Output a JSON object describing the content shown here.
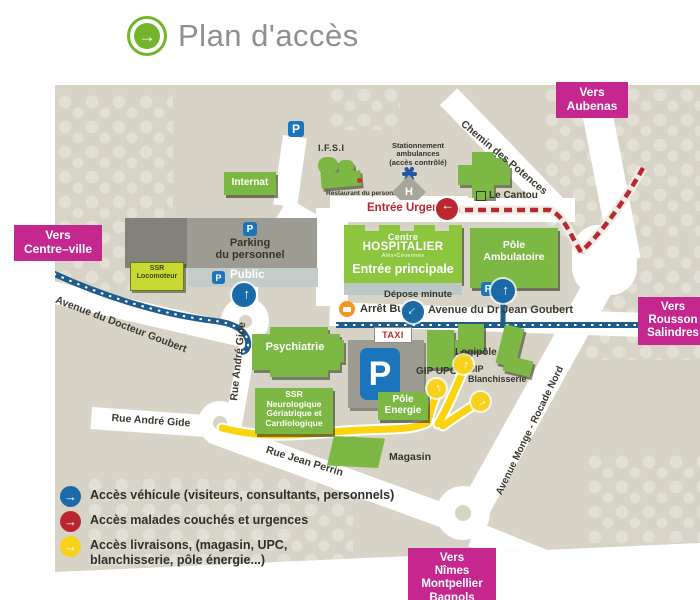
{
  "header": {
    "title": "Plan d'accès"
  },
  "directions": {
    "aubenas": "Vers\nAubenas",
    "centre_ville": "Vers\nCentre–ville",
    "rousson": "Vers\nRousson\nSalindres",
    "nimes": "Vers\nNîmes\nMontpellier\nBagnols"
  },
  "streets": {
    "chemin_des_potences": "Chemin des Potences",
    "avenue_docteur_goubert": "Avenue du Docteur Goubert",
    "rue_andre_gide_vertical": "Rue André Gide",
    "rue_andre_gide_horizontal": "Rue André Gide",
    "rue_jean_perrin": "Rue Jean Perrin",
    "avenue_dr_jean_goubert": "Avenue du Dr Jean Goubert",
    "avenue_monge": "Avenue Monge - Rocade Nord"
  },
  "hospital": {
    "logo_line1": "Centre",
    "logo_line2": "HOSPITALIER",
    "logo_line3": "Alès•Cévennes",
    "entree_principale": "Entrée principale",
    "entree_urgences": "Entrée  Urgences"
  },
  "buildings": {
    "internat": "Internat",
    "ifsi": "I.F.S.I",
    "restaurant_personnel": "Restaurant du personnel",
    "le_cantou": "Le Cantou",
    "parking_personnel": "Parking\ndu personnel",
    "parking_public": "Public",
    "ssr_locomoteur": "SSR\nLocomoteur",
    "pole_ambulatoire": "Pôle\nAmbulatoire",
    "psychiatrie": "Psychiatrie",
    "ssr_neurologique": "SSR\nNeurologique\nGériatrique et\nCardiologique",
    "pole_energie": "Pôle\nEnergie",
    "magasin": "Magasin",
    "logipole": "Logipôle",
    "gip_upc": "GIP UPC",
    "gip_blanchisserie": "GIP\nBlanchisserie"
  },
  "poi": {
    "taxi": "TAXI",
    "arret_bus": "Arrêt Bus",
    "depose_minute": "Dépose minute",
    "stationnement_ambulances": "Stationnement\nambulances\n(accès contrôlé)",
    "parking_letter": "P",
    "hopital_letter": "H"
  },
  "legend": {
    "items": [
      {
        "label": "Accès véhicule (visiteurs, consultants, personnels)",
        "color": "#1a6aa8"
      },
      {
        "label": "Accès malades couchés et urgences",
        "color": "#bb2730"
      },
      {
        "label": "Accès livraisons, (magasin, UPC,\nblanchisserie, pôle énergie...)",
        "color": "#f8d21a"
      }
    ]
  },
  "colors": {
    "map_background": "#d7d4c7",
    "building_green": "#7cb843",
    "hospital_green": "#8cc63e",
    "direction_magenta": "#c5278e",
    "route_blue": "#1d5c8d",
    "route_red": "#bb2730",
    "route_yellow": "#fbd40e",
    "parking_blue": "#1b75bc",
    "bus_orange": "#f7941e"
  }
}
